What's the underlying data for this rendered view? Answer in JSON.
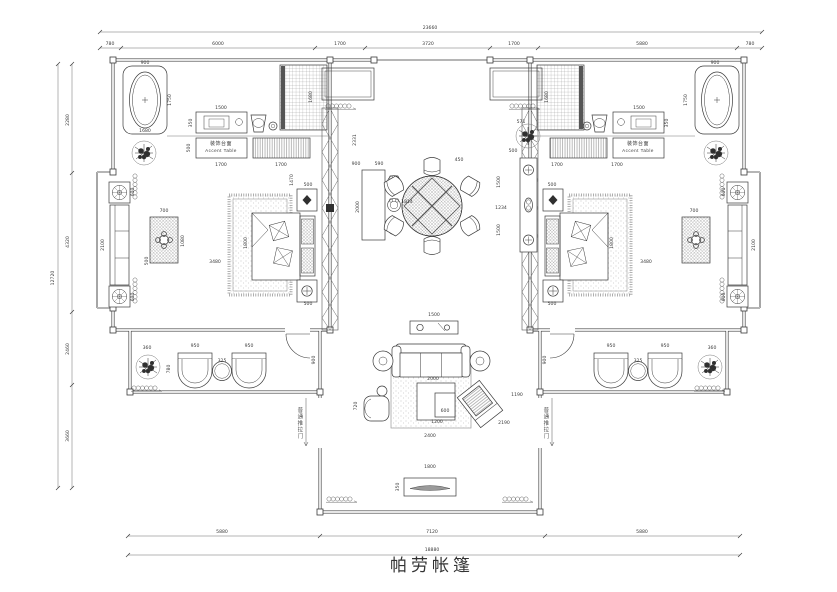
{
  "drawing": {
    "title": "帕劳帐篷",
    "labels": {
      "accent_table_cn": "装饰台面",
      "accent_table_en": "Accent Table",
      "sliding_door": "普通推拉门"
    },
    "colors": {
      "line": "#3a3a3a",
      "light": "#8c8c8c",
      "dark_fill": "#2f2f2f"
    },
    "dimensions": [
      [
        "23660",
        430,
        29,
        0,
        6
      ],
      [
        "780",
        110,
        45,
        0,
        5
      ],
      [
        "6000",
        218,
        45,
        0,
        5
      ],
      [
        "1700",
        340,
        45,
        0,
        5
      ],
      [
        "3720",
        428,
        45,
        0,
        5
      ],
      [
        "1700",
        514,
        45,
        0,
        5
      ],
      [
        "5880",
        642,
        45,
        0,
        5
      ],
      [
        "780",
        750,
        45,
        0,
        5
      ],
      [
        "5880",
        222,
        533,
        0,
        5
      ],
      [
        "7120",
        432,
        533,
        0,
        5
      ],
      [
        "5880",
        642,
        533,
        0,
        5
      ],
      [
        "18880",
        432,
        551,
        0,
        5
      ],
      [
        "12720",
        54,
        278,
        1,
        5
      ],
      [
        "2280",
        69,
        120,
        1,
        5
      ],
      [
        "4320",
        69,
        242,
        1,
        5
      ],
      [
        "2460",
        69,
        349,
        1,
        5
      ],
      [
        "3660",
        69,
        436,
        1,
        5
      ],
      [
        "900",
        145,
        64,
        0
      ],
      [
        "1750",
        171,
        100,
        1
      ],
      [
        "1680",
        145,
        132,
        0
      ],
      [
        "1500",
        221,
        109,
        0
      ],
      [
        "350",
        192,
        123,
        1
      ],
      [
        "1680",
        312,
        97,
        1
      ],
      [
        "500",
        190,
        148,
        1
      ],
      [
        "1700",
        221,
        166,
        0
      ],
      [
        "1700",
        281,
        166,
        0
      ],
      [
        "1470",
        293,
        180,
        1
      ],
      [
        "2100",
        104,
        245,
        1
      ],
      [
        "600",
        134,
        192,
        1
      ],
      [
        "600",
        134,
        297,
        1
      ],
      [
        "700",
        164,
        212,
        0
      ],
      [
        "1080",
        184,
        241,
        1
      ],
      [
        "500",
        148,
        261,
        1
      ],
      [
        "3480",
        215,
        263,
        0
      ],
      [
        "1800",
        247,
        243,
        1
      ],
      [
        "500",
        308,
        186,
        0
      ],
      [
        "500",
        308,
        305,
        0
      ],
      [
        "2331",
        356,
        140,
        1
      ],
      [
        "900",
        356,
        165,
        0
      ],
      [
        "590",
        379,
        165,
        0
      ],
      [
        "2000",
        359,
        207,
        1
      ],
      [
        "450",
        459,
        161,
        0
      ],
      [
        "1814",
        407,
        203,
        0
      ],
      [
        "1234",
        501,
        209,
        0
      ],
      [
        "500",
        513,
        152,
        0
      ],
      [
        "1500",
        500,
        182,
        1
      ],
      [
        "1500",
        500,
        230,
        1
      ],
      [
        "571",
        521,
        123,
        0
      ],
      [
        "1500",
        434,
        316,
        0
      ],
      [
        "2000",
        433,
        380,
        0
      ],
      [
        "600",
        445,
        412,
        0
      ],
      [
        "1200",
        437,
        423,
        0
      ],
      [
        "2400",
        430,
        437,
        0
      ],
      [
        "2190",
        504,
        424,
        0
      ],
      [
        "1190",
        517,
        396,
        0
      ],
      [
        "720",
        357,
        406,
        1
      ],
      [
        "1800",
        430,
        468,
        0
      ],
      [
        "350",
        399,
        487,
        1
      ],
      [
        "360",
        147,
        349,
        0
      ],
      [
        "950",
        195,
        347,
        0
      ],
      [
        "950",
        249,
        347,
        0
      ],
      [
        "325",
        222,
        362,
        0
      ],
      [
        "780",
        170,
        369,
        1
      ],
      [
        "900",
        315,
        360,
        1
      ],
      [
        "1700",
        557,
        166,
        0
      ],
      [
        "1700",
        617,
        166,
        0
      ],
      [
        "1500",
        639,
        109,
        0
      ],
      [
        "350",
        668,
        123,
        1
      ],
      [
        "900",
        715,
        64,
        0
      ],
      [
        "1750",
        687,
        100,
        1
      ],
      [
        "1680",
        548,
        97,
        1
      ],
      [
        "3480",
        646,
        263,
        0
      ],
      [
        "1800",
        613,
        243,
        1
      ],
      [
        "500",
        552,
        186,
        0
      ],
      [
        "500",
        552,
        305,
        0
      ],
      [
        "2100",
        755,
        245,
        1
      ],
      [
        "700",
        694,
        212,
        0
      ],
      [
        "600",
        725,
        192,
        1
      ],
      [
        "600",
        725,
        297,
        1
      ],
      [
        "950",
        611,
        347,
        0
      ],
      [
        "950",
        665,
        347,
        0
      ],
      [
        "325",
        638,
        362,
        0
      ],
      [
        "360",
        712,
        349,
        0
      ],
      [
        "900",
        546,
        360,
        1
      ]
    ]
  }
}
